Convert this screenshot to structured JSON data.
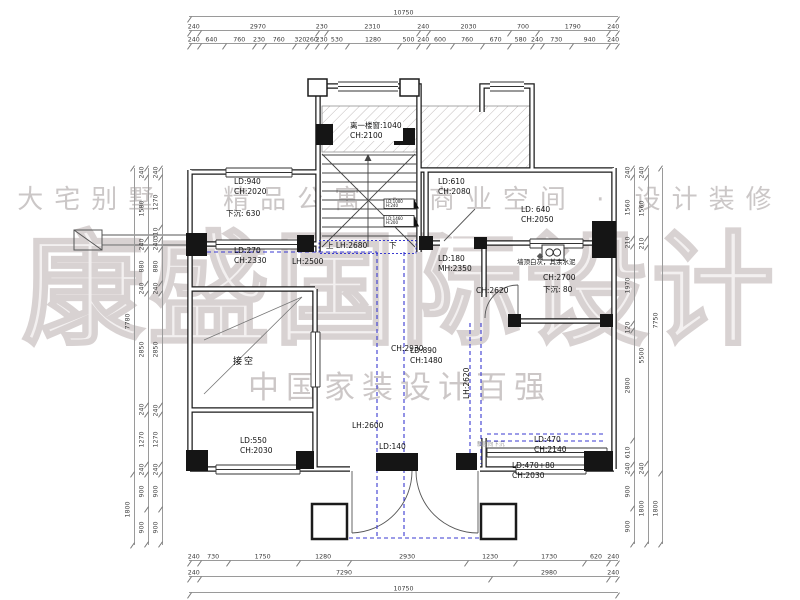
{
  "watermark": {
    "tagline": "大宅别墅 · 精品公寓 · 商业空间 · 设计装修",
    "logo": "康盛国际设计",
    "subtitle": "中国家装设计百强"
  },
  "colors": {
    "wall": "#1b1b1b",
    "beam_dash_blue": "#3a3ad0",
    "watermark_gray": "#cbc7c7",
    "hatch_gray": "#c2bcbc"
  },
  "dims": {
    "top": {
      "overall": [
        10750
      ],
      "major": [
        240,
        2970,
        230,
        2310,
        240,
        2030,
        700,
        1790,
        240
      ],
      "detail": [
        240,
        640,
        760,
        230,
        760,
        320,
        260,
        230,
        530,
        1280,
        500,
        240,
        600,
        760,
        670,
        580,
        240,
        730,
        940,
        240
      ]
    },
    "bottom": {
      "detail": [
        240,
        730,
        1750,
        1280,
        2930,
        1230,
        1730,
        620,
        240
      ],
      "major": [
        240,
        7290,
        2980,
        240
      ],
      "overall": [
        10750
      ]
    },
    "left": {
      "overall": [
        7780,
        1800
      ],
      "outer": [
        240,
        1580,
        240,
        880,
        240,
        2850,
        240,
        1270,
        240,
        900,
        900
      ],
      "inner": [
        240,
        1270,
        310,
        240,
        880,
        240,
        2850,
        240,
        1270,
        240,
        900,
        900
      ]
    },
    "right": {
      "inner": [
        240,
        1560,
        210,
        1970,
        120,
        2800,
        610,
        240,
        900,
        900
      ],
      "middle": [
        240,
        1560,
        210,
        5500,
        240,
        1800
      ],
      "overall": [
        7750,
        1800
      ]
    }
  },
  "plan": {
    "labels": {
      "stair_window_l1": "离一楼窗:1040",
      "stair_window_l2": "CH:2100",
      "room_tl_l1": "LD:940",
      "room_tl_l2": "CH:2020",
      "room_tl_sink": "下沉: 630",
      "room_tr_l1": "LD:610",
      "room_tr_l2": "CH:2080",
      "win_right_l1": "LD: 640",
      "win_right_l2": "CH:2050",
      "band_l1": "LD:270",
      "band_l2": "CH:2330",
      "lh2500": "LH:2500",
      "stair_up": "上 LH:2680",
      "stair_down": "下",
      "tag1_l1": "LD:1000",
      "tag1_l2": "H:240",
      "tag2_l1": "LD:1460",
      "tag2_l2": "H:200",
      "door_tr_l1": "LD:180",
      "door_tr_l2": "MH:2350",
      "bath_note": "墙顶白灰，其余水泥",
      "bath_ch": "CH:2700",
      "bath_sink": "下沉: 80",
      "bath_ch2": "CH:2620",
      "void_room": "接空",
      "win_void_l1": "LD:890",
      "win_void_l2": "CH:1480",
      "hall_ch": "CH:2930",
      "lh2620": "LH:2620",
      "lh2600": "LH:2600",
      "win_bl_l1": "LD:550",
      "win_bl_l2": "CH:2030",
      "door_b": "LD:140",
      "win_br1_l1": "LD:470",
      "win_br1_l2": "CH:2140",
      "br_note": "飘窗向下沉",
      "win_br2_l1": "LD:470+80",
      "win_br2_l2": "CH:2030"
    }
  }
}
